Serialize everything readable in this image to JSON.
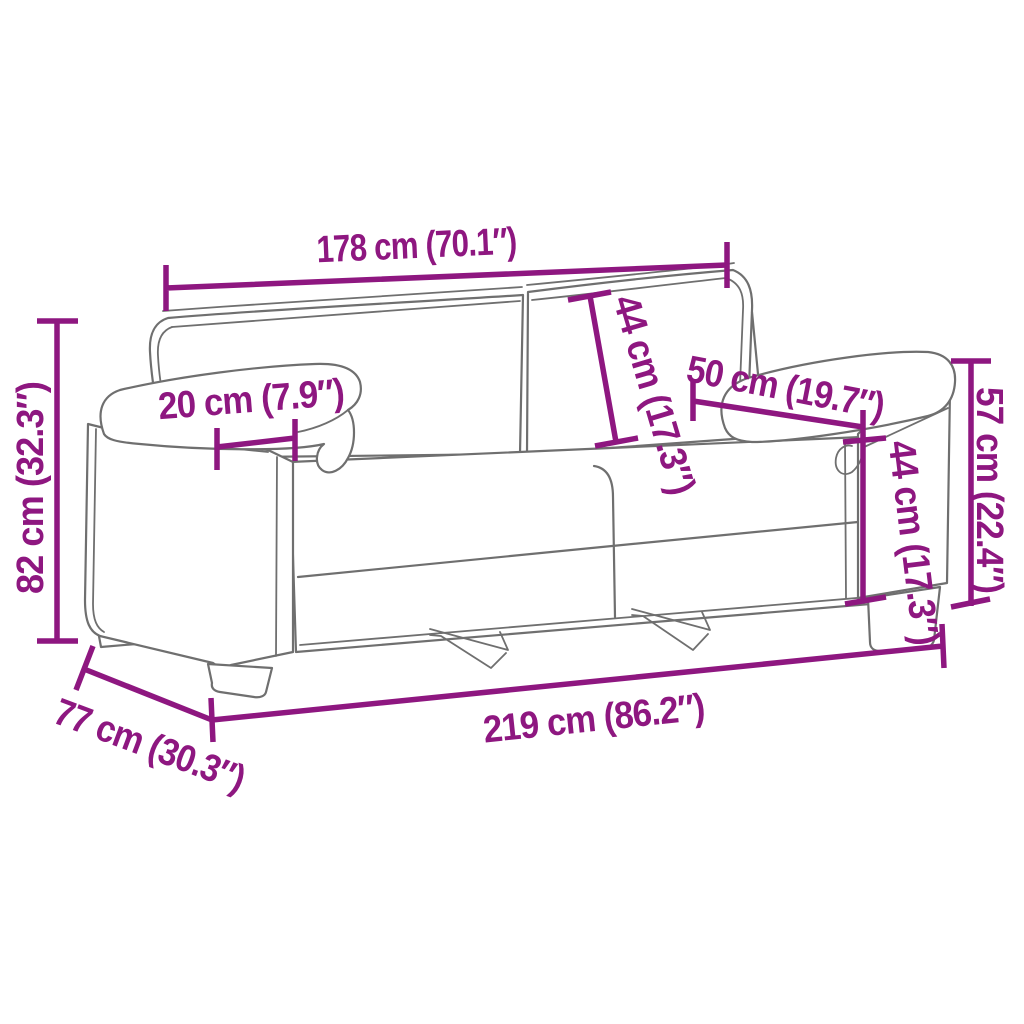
{
  "title": "Sofa dimensions diagram",
  "colors": {
    "accent": "#8E1780",
    "outline": "#6F6F6F",
    "background": "#FFFFFF"
  },
  "labels": {
    "inner_width": "178 cm (70.1″)",
    "back_cushion_height": "44 cm (17.3″)",
    "armrest_depth": "50 cm (19.7″)",
    "seat_height": "44 cm (17.3″)",
    "armrest_height": "57 cm (22.4″)",
    "total_height": "82 cm (32.3″)",
    "armrest_width": "20 cm (7.9″)",
    "total_width": "219 cm (86.2″)",
    "total_depth": "77 cm (30.3″)"
  }
}
